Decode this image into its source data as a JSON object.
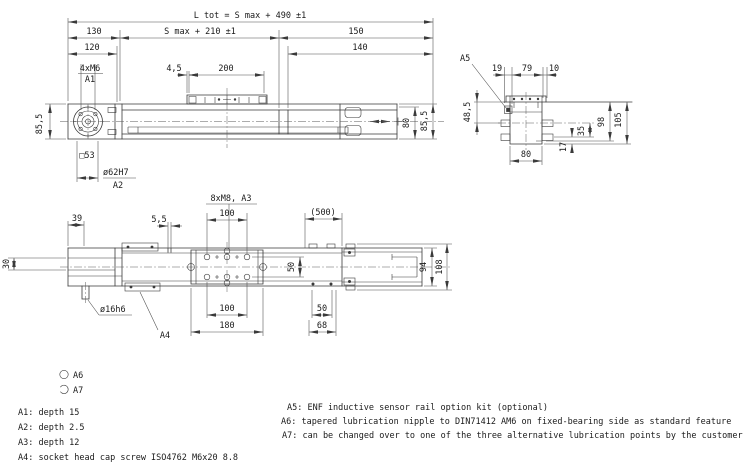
{
  "side_view": {
    "l_tot": "L tot = S max + 490 ±1",
    "s_max": "S max + 210 ±1",
    "d130": "130",
    "d120": "120",
    "d150": "150",
    "d140": "140",
    "m6": "4xM6",
    "a1": "A1",
    "d45": "4,5",
    "d200": "200",
    "d855_left": "85,5",
    "d80": "80",
    "d855_right": "85,5",
    "sq53": "□53",
    "dia62": "ø62H7",
    "a2": "A2"
  },
  "end_view": {
    "a5": "A5",
    "d19": "19",
    "d79": "79",
    "d10": "10",
    "d485": "48,5",
    "d98": "98",
    "d105": "105",
    "d35": "35",
    "d17": "17",
    "d80": "80"
  },
  "plan_view": {
    "d39": "39",
    "d55": "5,5",
    "m8": "8xM8, A3",
    "d100_top": "100",
    "d500": "(500)",
    "d30": "30",
    "d50_mid": "50",
    "d94": "94",
    "d108": "108",
    "dia16": "ø16h6",
    "a4": "A4",
    "d100_bottom": "100",
    "d180": "180",
    "d50_right": "50",
    "d68": "68"
  },
  "legend": {
    "a6": "A6",
    "a7": "A7"
  },
  "notes": {
    "left": [
      "A1: depth 15",
      "A2: depth 2.5",
      "A3: depth 12",
      "A4: socket head cap screw ISO4762 M6x20 8.8"
    ],
    "right": [
      "A5: ENF inductive sensor rail option kit (optional)",
      "A6: tapered lubrication nipple to DIN71412 AM6 on fixed-bearing side as standard feature",
      "A7: can be changed over to one of the three alternative lubrication points by the customer"
    ]
  },
  "colors": {
    "line": "#3a3a3a",
    "text": "#1a1a1a",
    "background": "#ffffff"
  }
}
